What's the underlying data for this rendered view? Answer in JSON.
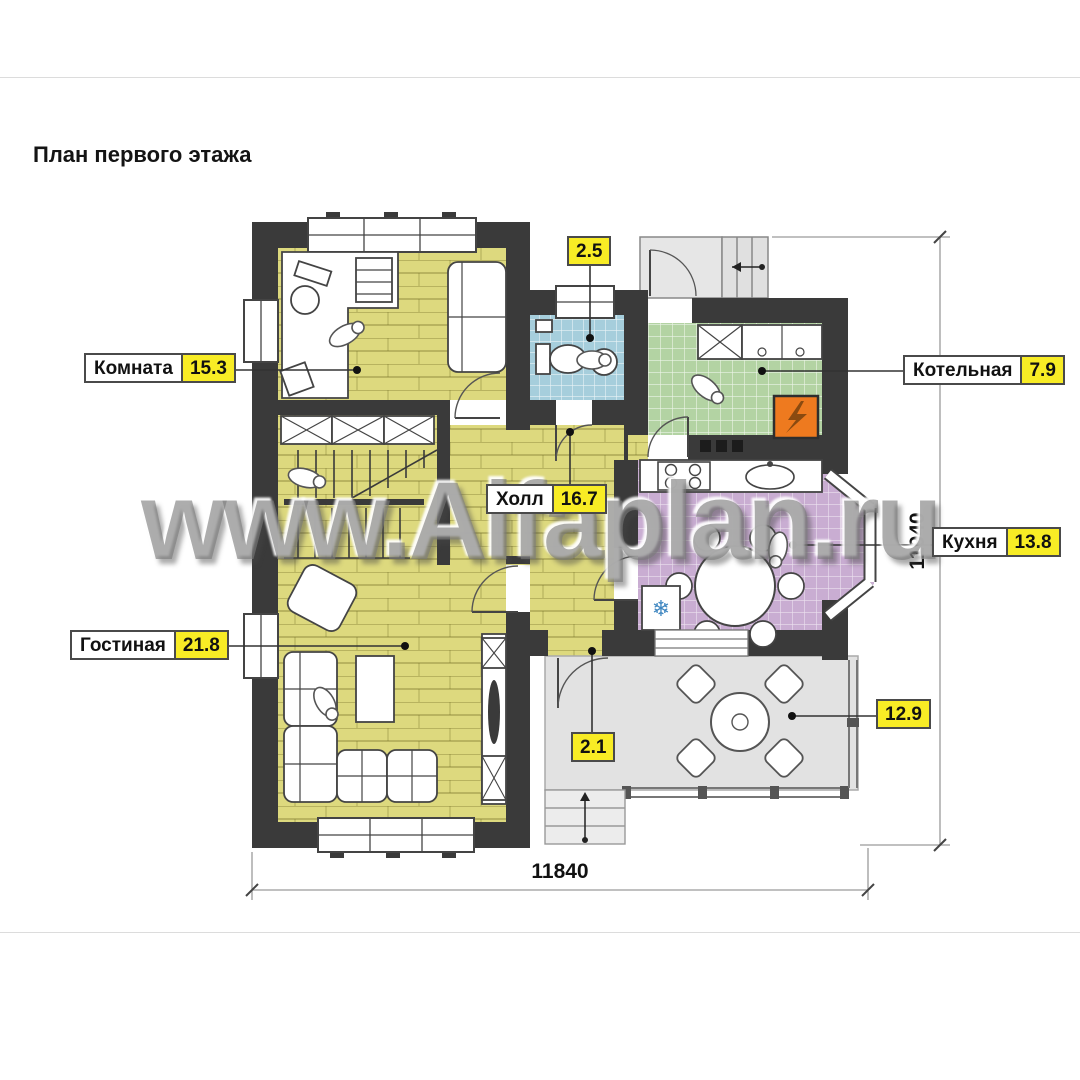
{
  "page": {
    "title": "План первого этажа",
    "watermark": "www.Alfaplan.ru"
  },
  "labels": {
    "komnata": {
      "name": "Комната",
      "area": "15.3"
    },
    "kotelnaya": {
      "name": "Котельная",
      "area": "7.9"
    },
    "kuhnya": {
      "name": "Кухня",
      "area": "13.8"
    },
    "gostinaya": {
      "name": "Гостиная",
      "area": "21.8"
    },
    "holl": {
      "name": "Холл",
      "area": "16.7"
    },
    "sanuzel": {
      "area": "2.5"
    },
    "tambur": {
      "area": "2.1"
    },
    "terrasa": {
      "area": "12.9"
    }
  },
  "dimensions": {
    "overall_width": "11840",
    "overall_depth": "11940"
  },
  "icons": {
    "snowflake": "❄"
  },
  "colors": {
    "label_area_bg": "#f8ec25",
    "wall": "#3a3a3a",
    "floor_yellow": "#ddd97e",
    "tile_blue": "#a6cedc",
    "tile_green": "#b3d3a3",
    "tile_purple": "#c9add2",
    "terrace_gray": "#e2e2e2",
    "boiler_orange": "#ee7a1f"
  }
}
